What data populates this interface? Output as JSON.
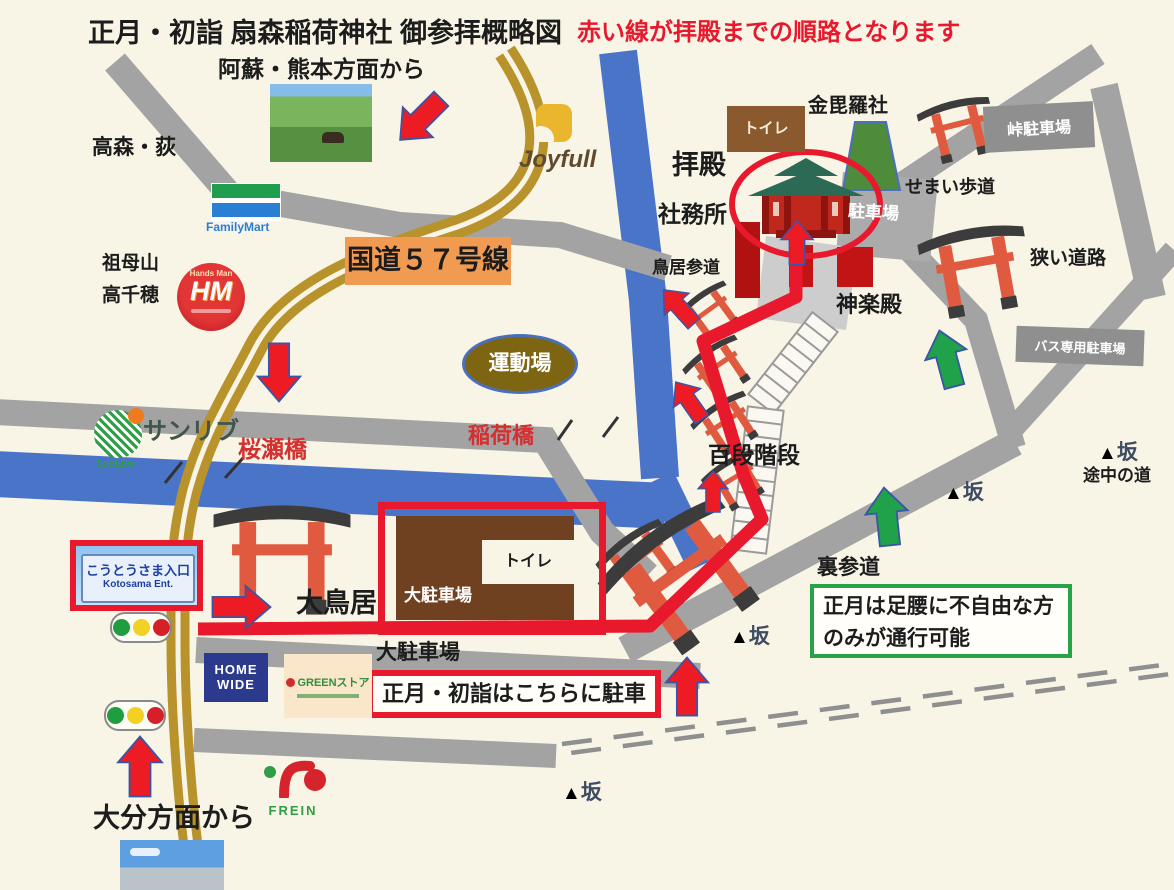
{
  "title": "正月・初詣 扇森稲荷神社 御参拝概略図",
  "legend_note": "赤い線が拝殿までの順路となります",
  "directions": {
    "from_aso_kumamoto": "阿蘇・熊本方面から",
    "from_oita": "大分方面から",
    "takamori_ogi": "高森・荻",
    "sobo_san": "祖母山",
    "takachiho": "高千穂"
  },
  "roads": {
    "national_route_57": "国道５７号線",
    "sakurase_bridge": "桜瀬橋",
    "inari_bridge": "稲荷橋",
    "narrow_walkway": "せまい歩道",
    "narrow_road": "狭い道路",
    "midway_road": "途中の道",
    "slope_triangle": "▲",
    "slope": "坂"
  },
  "shrine": {
    "haiden": "拝殿",
    "shamusho": "社務所",
    "konpirasha": "金毘羅社",
    "kaguraden": "神楽殿",
    "torii_sando": "鳥居参道",
    "hyakudan_kaidan": "百段階段",
    "ura_sando": "裏参道",
    "ura_sando_note_line1": "正月は足腰に不自由な方",
    "ura_sando_note_line2": "のみが通行可能",
    "otorii": "大鳥居",
    "undojo": "運動場"
  },
  "parking": {
    "main_lot": "大駐車場",
    "main_lot_road_label": "大駐車場",
    "new_year_note": "正月・初詣はこちらに駐車",
    "toilet_main_lot": "トイレ",
    "toilet_haiden": "トイレ",
    "haiden_lot": "駐車場",
    "touge_lot": "峠駐車場",
    "bus_lot": "バス専用駐車場"
  },
  "entrance_sign": {
    "japanese": "こうとうさま入口",
    "english": "Kotosama Ent."
  },
  "logos": {
    "joyfull": "Joyfull",
    "familymart": "FamilyMart",
    "handsman_initials": "HM",
    "handsman_arc": "Hands Man",
    "sunlive": "サンリブ",
    "sunlive_en": "SunLive",
    "homewide_top": "HOME",
    "homewide_bottom": "WIDE",
    "green_store": "GREENストア",
    "frein": "FREIN"
  },
  "colors": {
    "background": "#f8f4e6",
    "route_red": "#e8192c",
    "road_gray": "#a3a3a3",
    "road_gold": "#b8922a",
    "road_blue": "#4a74c8",
    "arrow_green": "#1fa24a",
    "highlight_orange": "#f09a52"
  }
}
